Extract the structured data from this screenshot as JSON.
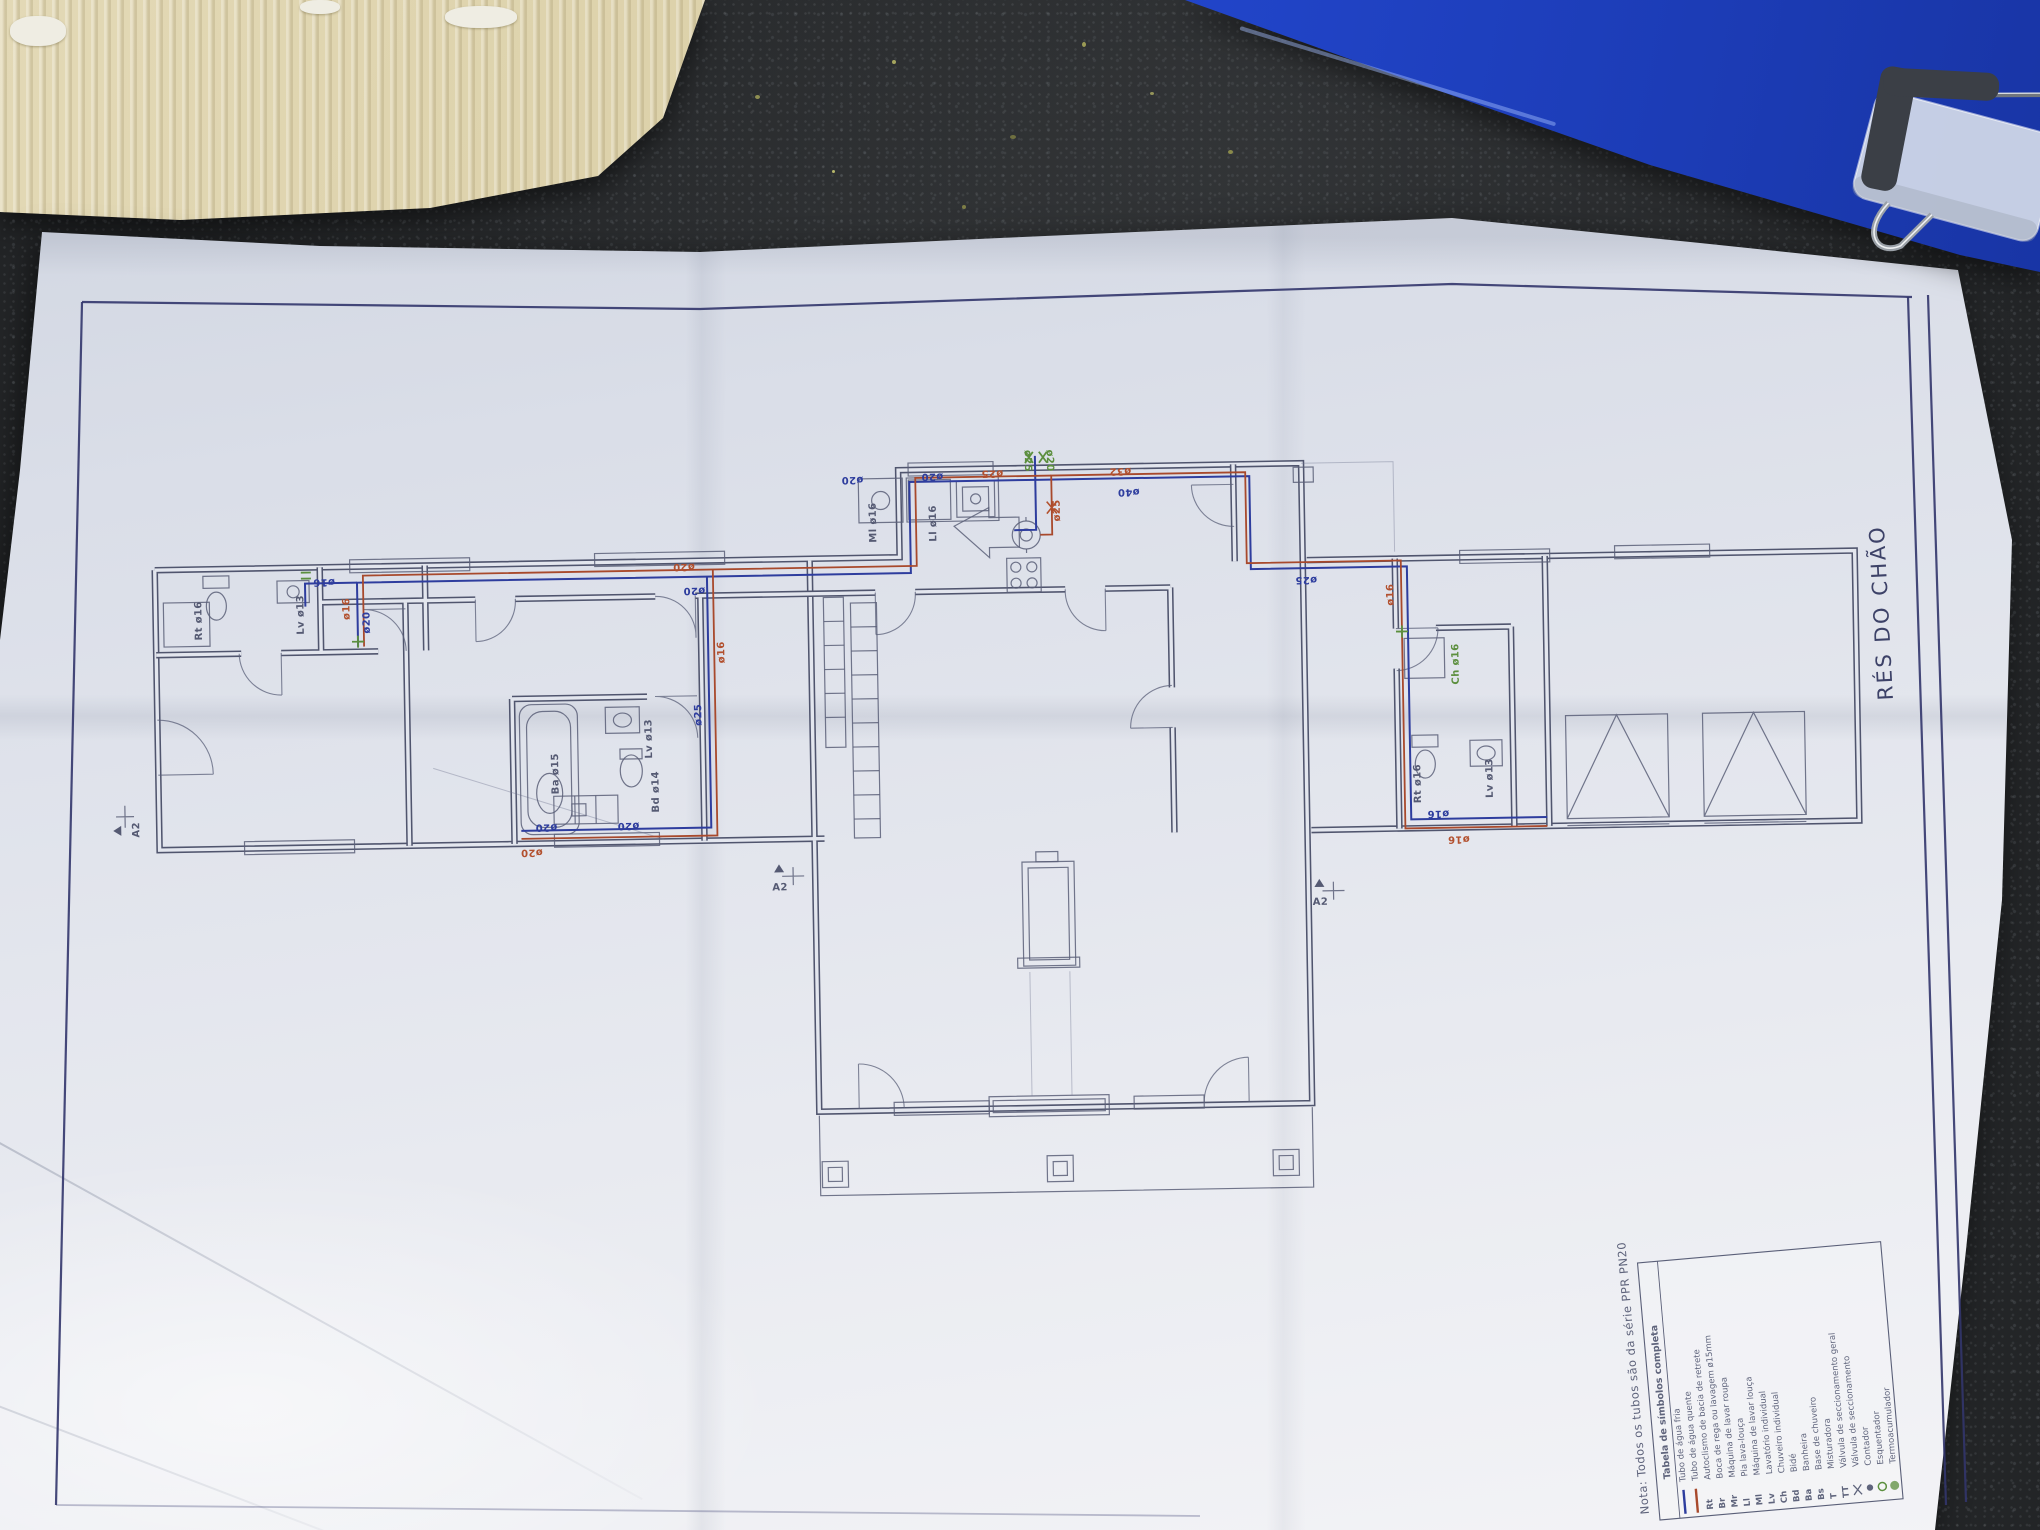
{
  "sheet": {
    "title": "RÉS DO CHÃO",
    "note": "Nota: Todos os tubos são da série PPR PN20",
    "legend": {
      "title": "Tabela de símbolos completa",
      "entries": [
        {
          "sym": "line-cold",
          "code": "",
          "label": "Tubo de água fria"
        },
        {
          "sym": "line-hot",
          "code": "",
          "label": "Tubo de água quente"
        },
        {
          "sym": "code",
          "code": "Rt",
          "label": "Autoclismo de bacia de retrete"
        },
        {
          "sym": "code",
          "code": "Br",
          "label": "Boca de rega ou lavagem ø15mm"
        },
        {
          "sym": "code",
          "code": "Mr",
          "label": "Máquina de lavar roupa"
        },
        {
          "sym": "code",
          "code": "Ll",
          "label": "Pia lava-louça"
        },
        {
          "sym": "code",
          "code": "Ml",
          "label": "Máquina de lavar louça"
        },
        {
          "sym": "code",
          "code": "Lv",
          "label": "Lavatório individual"
        },
        {
          "sym": "code",
          "code": "Ch",
          "label": "Chuveiro individual"
        },
        {
          "sym": "code",
          "code": "Bd",
          "label": "Bidé"
        },
        {
          "sym": "code",
          "code": "Ba",
          "label": "Banheira"
        },
        {
          "sym": "code",
          "code": "Bs",
          "label": "Base de chuveiro"
        },
        {
          "sym": "code",
          "code": "T",
          "label": "Misturadora"
        },
        {
          "sym": "code",
          "code": "TT",
          "label": "Válvula de seccionamento geral"
        },
        {
          "sym": "valve",
          "code": "",
          "label": "Válvula de seccionamento"
        },
        {
          "sym": "dot",
          "code": "",
          "label": "Contador"
        },
        {
          "sym": "circle-green",
          "code": "",
          "label": "Esquentador"
        },
        {
          "sym": "disc-green",
          "code": "",
          "label": "Termoacumulador"
        }
      ]
    },
    "pipe_labels": [
      {
        "t": "ø16",
        "x": 330,
        "y": 577,
        "r": 180,
        "c": "cold"
      },
      {
        "t": "ø20",
        "x": 690,
        "y": 568,
        "r": 180,
        "c": "hot"
      },
      {
        "t": "ø20",
        "x": 700,
        "y": 592,
        "r": 180,
        "c": "cold"
      },
      {
        "t": "ø16",
        "x": 344,
        "y": 618,
        "r": -90,
        "c": "hot"
      },
      {
        "t": "ø20",
        "x": 364,
        "y": 632,
        "r": -90,
        "c": "cold"
      },
      {
        "t": "ø20",
        "x": 548,
        "y": 826,
        "r": 180,
        "c": "cold"
      },
      {
        "t": "ø20",
        "x": 533,
        "y": 851,
        "r": 180,
        "c": "hot"
      },
      {
        "t": "ø20",
        "x": 630,
        "y": 826,
        "r": 180,
        "c": "cold"
      },
      {
        "t": "ø25",
        "x": 694,
        "y": 730,
        "r": -90,
        "c": "cold"
      },
      {
        "t": "ø16",
        "x": 718,
        "y": 668,
        "r": -90,
        "c": "hot"
      },
      {
        "t": "ø20",
        "x": 860,
        "y": 484,
        "r": 180,
        "c": "cold"
      },
      {
        "t": "ø20",
        "x": 940,
        "y": 482,
        "r": 180,
        "c": "cold"
      },
      {
        "t": "ø25",
        "x": 1000,
        "y": 480,
        "r": 180,
        "c": "hot"
      },
      {
        "t": "ø25",
        "x": 1022,
        "y": 460,
        "r": 90,
        "c": "green"
      },
      {
        "t": "ø20",
        "x": 1044,
        "y": 460,
        "r": 90,
        "c": "green"
      },
      {
        "t": "ø25",
        "x": 1056,
        "y": 532,
        "r": -90,
        "c": "hot"
      },
      {
        "t": "ø32",
        "x": 1128,
        "y": 480,
        "r": 180,
        "c": "hot"
      },
      {
        "t": "ø40",
        "x": 1136,
        "y": 501,
        "r": 180,
        "c": "cold"
      },
      {
        "t": "ø25",
        "x": 1312,
        "y": 592,
        "r": 180,
        "c": "cold"
      },
      {
        "t": "ø16",
        "x": 1388,
        "y": 622,
        "r": -90,
        "c": "hot"
      },
      {
        "t": "ø16",
        "x": 1440,
        "y": 828,
        "r": 180,
        "c": "cold"
      },
      {
        "t": "ø16",
        "x": 1460,
        "y": 854,
        "r": 180,
        "c": "hot"
      }
    ],
    "fixture_labels": [
      {
        "t": "Rt ø16",
        "x": 196,
        "y": 636,
        "r": -90,
        "c": "ink"
      },
      {
        "t": "Lv ø13",
        "x": 298,
        "y": 632,
        "r": -90,
        "c": "ink"
      },
      {
        "t": "Ba ø15",
        "x": 550,
        "y": 796,
        "r": -90,
        "c": "ink"
      },
      {
        "t": "Lv ø13",
        "x": 644,
        "y": 762,
        "r": -90,
        "c": "ink"
      },
      {
        "t": "Bd ø14",
        "x": 650,
        "y": 816,
        "r": -90,
        "c": "ink"
      },
      {
        "t": "Ml ø16",
        "x": 872,
        "y": 550,
        "r": -90,
        "c": "ink"
      },
      {
        "t": "Ll ø16",
        "x": 932,
        "y": 550,
        "r": -90,
        "c": "ink"
      },
      {
        "t": "Ch ø16",
        "x": 1452,
        "y": 702,
        "r": -90,
        "c": "green"
      },
      {
        "t": "Rt ø16",
        "x": 1412,
        "y": 820,
        "r": -90,
        "c": "ink"
      },
      {
        "t": "Lv ø13",
        "x": 1484,
        "y": 816,
        "r": -90,
        "c": "ink"
      }
    ],
    "markers": [
      {
        "t": "A2",
        "x": 772,
        "y": 882,
        "r": 0
      },
      {
        "t": "A2",
        "x": 1312,
        "y": 906,
        "r": 0
      },
      {
        "t": "A2",
        "x": 116,
        "y": 822,
        "r": -90
      }
    ],
    "colors": {
      "paper": "#e3e6ee",
      "ink": "#50556e",
      "cold": "#2e3d9e",
      "hot": "#a8492c",
      "green": "#5c8f3e",
      "border": "#32356b",
      "folder": "#2449d2",
      "cardboard": "#d8cca2",
      "granite": "#232527"
    }
  }
}
